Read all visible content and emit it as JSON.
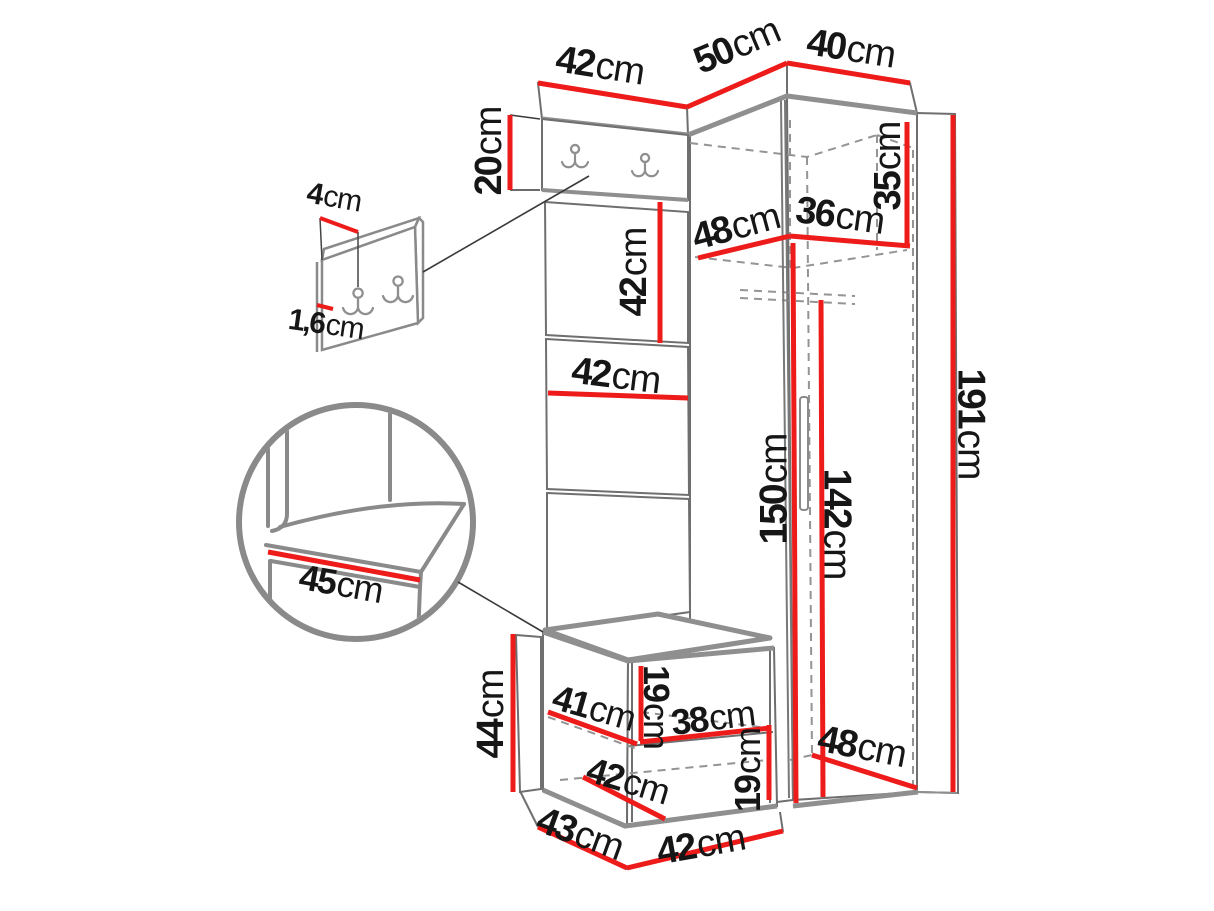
{
  "diagram": {
    "kind": "furniture-dimension-diagram",
    "unit": "cm"
  },
  "colors": {
    "dimension_line": "#ee1b1b",
    "outline": "#6f6f6f",
    "outline_thick": "#8f8f8f",
    "hidden_line": "#949494",
    "text": "#161616"
  },
  "dimensions": [
    {
      "id": "top-panel-width",
      "value": "42",
      "unit": "cm",
      "line": [
        538,
        83,
        687,
        107
      ],
      "w": 5,
      "label": {
        "x": 600,
        "y": 66,
        "rot": 9,
        "size": 38
      }
    },
    {
      "id": "top-corner-left-width",
      "value": "50",
      "unit": "cm",
      "line": [
        687,
        107,
        787,
        63
      ],
      "w": 5,
      "label": {
        "x": 737,
        "y": 46,
        "rot": -23,
        "size": 38
      }
    },
    {
      "id": "top-corner-right-width",
      "value": "40",
      "unit": "cm",
      "line": [
        787,
        63,
        910,
        83
      ],
      "w": 5,
      "label": {
        "x": 851,
        "y": 49,
        "rot": 9,
        "size": 38
      }
    },
    {
      "id": "hook-panel-height",
      "value": "20",
      "unit": "cm",
      "line": [
        510,
        115,
        510,
        190
      ],
      "w": 5,
      "label": {
        "x": 489,
        "y": 151,
        "rot": -90,
        "size": 38
      }
    },
    {
      "id": "detail-hook-offset",
      "value": "4",
      "unit": "cm",
      "line": [
        320,
        218,
        358,
        232
      ],
      "w": 4,
      "label": {
        "x": 334,
        "y": 198,
        "rot": 10,
        "size": 30
      }
    },
    {
      "id": "detail-panel-thickness",
      "value": "1,6",
      "unit": "cm",
      "line": [
        317,
        305,
        333,
        309
      ],
      "w": 4,
      "label": {
        "x": 326,
        "y": 325,
        "rot": 8,
        "size": 30
      }
    },
    {
      "id": "wall-panel-height",
      "value": "42",
      "unit": "cm",
      "line": [
        660,
        202,
        660,
        343
      ],
      "w": 5,
      "label": {
        "x": 634,
        "y": 272,
        "rot": -90,
        "size": 38
      }
    },
    {
      "id": "wall-panel-width",
      "value": "42",
      "unit": "cm",
      "line": [
        548,
        393,
        688,
        398
      ],
      "w": 5,
      "label": {
        "x": 616,
        "y": 376,
        "rot": 7,
        "size": 38
      }
    },
    {
      "id": "wardrobe-inner-depth",
      "value": "48",
      "unit": "cm",
      "line": [
        698,
        258,
        790,
        236
      ],
      "w": 5,
      "label": {
        "x": 736,
        "y": 227,
        "rot": -15,
        "size": 38
      }
    },
    {
      "id": "wardrobe-inner-width",
      "value": "36",
      "unit": "cm",
      "line": [
        790,
        236,
        910,
        246
      ],
      "w": 5,
      "label": {
        "x": 840,
        "y": 216,
        "rot": 8,
        "size": 38
      }
    },
    {
      "id": "top-shelf-height",
      "value": "35",
      "unit": "cm",
      "line": [
        907,
        122,
        907,
        246
      ],
      "w": 5,
      "label": {
        "x": 888,
        "y": 166,
        "rot": -90,
        "size": 38
      }
    },
    {
      "id": "wardrobe-height",
      "value": "191",
      "unit": "cm",
      "line": [
        953,
        115,
        953,
        792
      ],
      "w": 5,
      "label": {
        "x": 971,
        "y": 424,
        "rot": 90,
        "size": 39
      }
    },
    {
      "id": "interior-height",
      "value": "150",
      "unit": "cm",
      "line": [
        793,
        243,
        796,
        803
      ],
      "w": 5,
      "label": {
        "x": 774,
        "y": 489,
        "rot": -90,
        "size": 39
      }
    },
    {
      "id": "hanging-space-height",
      "value": "142",
      "unit": "cm",
      "line": [
        821,
        300,
        823,
        797
      ],
      "w": 5,
      "label": {
        "x": 837,
        "y": 524,
        "rot": 90,
        "size": 39
      }
    },
    {
      "id": "seat-depth-detail",
      "value": "45",
      "unit": "cm",
      "line": [
        268,
        552,
        420,
        580
      ],
      "w": 5,
      "label": {
        "x": 341,
        "y": 584,
        "rot": 10,
        "size": 36
      }
    },
    {
      "id": "bench-height",
      "value": "44",
      "unit": "cm",
      "line": [
        513,
        634,
        513,
        792
      ],
      "w": 5,
      "label": {
        "x": 491,
        "y": 714,
        "rot": -90,
        "size": 38
      }
    },
    {
      "id": "bench-shelf-depth",
      "value": "41",
      "unit": "cm",
      "line": [
        548,
        712,
        637,
        744
      ],
      "w": 5,
      "label": {
        "x": 594,
        "y": 708,
        "rot": 16,
        "size": 36
      }
    },
    {
      "id": "bench-upper-opening",
      "value": "19",
      "unit": "cm",
      "line": [
        641,
        666,
        641,
        741
      ],
      "w": 5,
      "label": {
        "x": 656,
        "y": 707,
        "rot": 90,
        "size": 36
      }
    },
    {
      "id": "bench-shelf-width",
      "value": "38",
      "unit": "cm",
      "line": [
        640,
        742,
        770,
        728
      ],
      "w": 5,
      "label": {
        "x": 713,
        "y": 718,
        "rot": -7,
        "size": 36
      }
    },
    {
      "id": "bench-lower-depth",
      "value": "42",
      "unit": "cm",
      "line": [
        583,
        777,
        665,
        819
      ],
      "w": 5,
      "label": {
        "x": 628,
        "y": 781,
        "rot": 17,
        "size": 36
      }
    },
    {
      "id": "bench-lower-opening",
      "value": "19",
      "unit": "cm",
      "line": [
        769,
        725,
        769,
        800
      ],
      "w": 5,
      "label": {
        "x": 748,
        "y": 770,
        "rot": -90,
        "size": 36
      }
    },
    {
      "id": "bench-depth",
      "value": "43",
      "unit": "cm",
      "line": [
        538,
        827,
        627,
        868
      ],
      "w": 5,
      "label": {
        "x": 580,
        "y": 834,
        "rot": 20,
        "size": 38
      }
    },
    {
      "id": "bench-width",
      "value": "42",
      "unit": "cm",
      "line": [
        627,
        868,
        783,
        831
      ],
      "w": 5,
      "label": {
        "x": 701,
        "y": 845,
        "rot": -10,
        "size": 38
      }
    },
    {
      "id": "wardrobe-floor-depth",
      "value": "48",
      "unit": "cm",
      "line": [
        812,
        755,
        917,
        788
      ],
      "w": 5,
      "label": {
        "x": 862,
        "y": 747,
        "rot": 11,
        "size": 38
      }
    }
  ]
}
